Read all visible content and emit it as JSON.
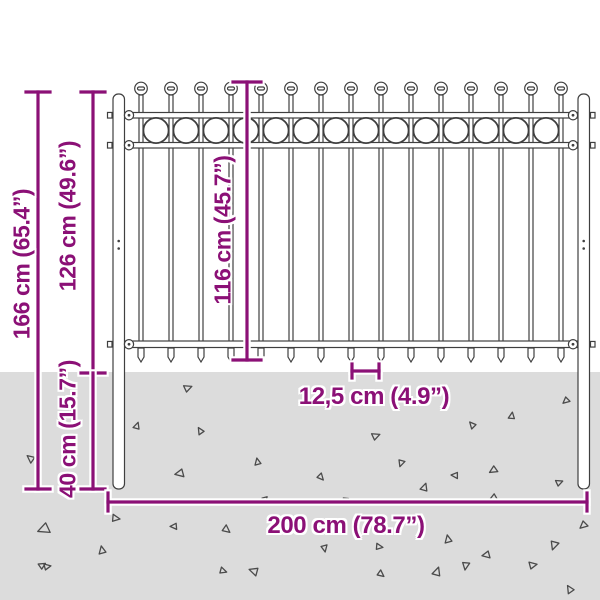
{
  "diagram": {
    "kind": "fence-dimension-diagram",
    "subject": "steel fence panel with ball-top pickets, ring ornaments and two round posts set into the ground"
  },
  "colors": {
    "accent": "#8b1076",
    "ground": "#dcdcdc",
    "line": "#3f3f3f",
    "background": "#ffffff"
  },
  "dims": {
    "total": {
      "label": "166 cm (65.4”)"
    },
    "above": {
      "label": "126 cm (49.6”)"
    },
    "picket": {
      "label": "116 cm (45.7”)"
    },
    "below": {
      "label": "40 cm (15.7”)"
    },
    "spacing": {
      "label": "12,5 cm (4.9”)"
    },
    "width": {
      "label": "200 cm (78.7”)"
    }
  },
  "fence": {
    "picket_count": 15,
    "ring_count": 14,
    "post_count": 2,
    "rail_count": 3
  },
  "ground": {
    "triangle_marks": [
      [
        183,
        384,
        8,
        200
      ],
      [
        133,
        423,
        7,
        150
      ],
      [
        197,
        428,
        7,
        100
      ],
      [
        27,
        455,
        8,
        80
      ],
      [
        176,
        469,
        9,
        30
      ],
      [
        254,
        459,
        7,
        120
      ],
      [
        262,
        496,
        6,
        300
      ],
      [
        39,
        523,
        12,
        20
      ],
      [
        111,
        514,
        8,
        230
      ],
      [
        171,
        523,
        7,
        40
      ],
      [
        222,
        525,
        8,
        260
      ],
      [
        98,
        547,
        8,
        120
      ],
      [
        43,
        563,
        7,
        210
      ],
      [
        250,
        567,
        9,
        60
      ],
      [
        38,
        562,
        7,
        190
      ],
      [
        219,
        567,
        7,
        240
      ],
      [
        377,
        570,
        7,
        260
      ],
      [
        462,
        561,
        8,
        320
      ],
      [
        563,
        397,
        7,
        0
      ],
      [
        508,
        413,
        7,
        140
      ],
      [
        469,
        422,
        7,
        90
      ],
      [
        371,
        432,
        8,
        200
      ],
      [
        398,
        459,
        7,
        330
      ],
      [
        317,
        473,
        7,
        270
      ],
      [
        452,
        472,
        7,
        45
      ],
      [
        490,
        466,
        8,
        10
      ],
      [
        420,
        484,
        8,
        150
      ],
      [
        555,
        479,
        7,
        200
      ],
      [
        489,
        494,
        10,
        15
      ],
      [
        407,
        516,
        8,
        60
      ],
      [
        580,
        521,
        8,
        0
      ],
      [
        375,
        543,
        7,
        230
      ],
      [
        444,
        536,
        8,
        120
      ],
      [
        321,
        544,
        7,
        300
      ],
      [
        483,
        551,
        8,
        30
      ],
      [
        550,
        540,
        9,
        330
      ],
      [
        528,
        561,
        8,
        210
      ],
      [
        432,
        568,
        9,
        150
      ],
      [
        343,
        497,
        5,
        200
      ],
      [
        566,
        586,
        8,
        100
      ]
    ]
  }
}
